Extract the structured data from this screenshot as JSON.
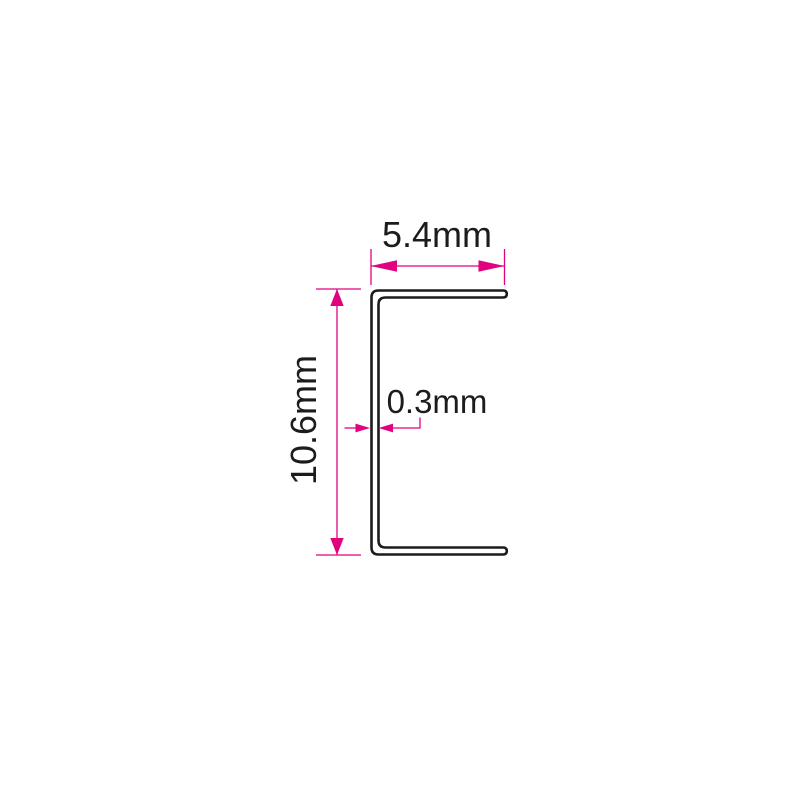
{
  "drawing": {
    "dimensions": {
      "width": {
        "label": "5.4mm"
      },
      "height": {
        "label": "10.6mm"
      },
      "thickness": {
        "label": "0.3mm"
      }
    },
    "colors": {
      "dimension_accent": "#e0027f",
      "outline": "#1c1c1c",
      "background": "#ffffff"
    }
  }
}
